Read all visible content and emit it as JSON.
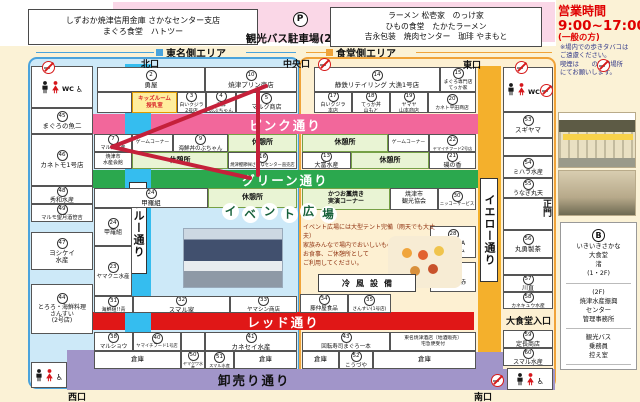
{
  "title_area": {
    "bank_box_line1": "しずおか焼津信用金庫 さかなセンター支店",
    "bank_box_line2": "まぐろ食堂　ハトツー",
    "parking_symbol": "P",
    "parking_label": "観光バス駐車場(25台)",
    "restaurants_line1": "ラーメン 松壱家　のっけ家",
    "restaurants_line2": "ひもの食堂　たかたラーメン",
    "restaurants_line3": "吉永包装　焼肉センター　珈琲 やまもと",
    "hours_title": "営業時間",
    "hours_time": "9:00~17:00",
    "hours_note": "(一般の方)"
  },
  "areas": {
    "left": "東名側エリア",
    "right": "食堂側エリア"
  },
  "streets": {
    "blue": "ブルー通り",
    "yellow": "イエロー通り",
    "pink": "ピンク通り",
    "green": "グリーン通り",
    "red": "レッド通り",
    "wholesale": "卸売り通り"
  },
  "event_plaza": {
    "title_chars": [
      "イ",
      "ベ",
      "ン",
      "ト",
      "広",
      "場"
    ],
    "text_lines": [
      "イベント広場には大型テント完備（雨天でも大丈夫）",
      "家族みんなで場内でおいしいものを買い",
      "お食事、ご休憩所として",
      "ご利用してください。"
    ],
    "cooling_label": "冷風設備"
  },
  "side_panel": {
    "smoking_lines": [
      "※場内での歩きタバコは",
      "ご遠慮ください。",
      "喫煙は　　の喫煙場所",
      "にてお願いします。"
    ],
    "directory": {
      "b_symbol": "B",
      "restaurant_lines": [
        "いきいきさかな",
        "大食堂",
        "渚",
        "(1・2F)"
      ],
      "office_lines": [
        "(2F)",
        "焼津水産振興",
        "センター",
        "管理事務所"
      ],
      "bus_lines": [
        "観光バス",
        "乗務員",
        "控え室"
      ]
    }
  },
  "map": {
    "gates": [
      {
        "label": "北口",
        "x": 141,
        "y": 57
      },
      {
        "label": "中央口",
        "x": 283,
        "y": 57
      },
      {
        "label": "東口",
        "x": 463,
        "y": 58
      },
      {
        "label": "西口",
        "x": 68,
        "y": 390
      },
      {
        "label": "南口",
        "x": 474,
        "y": 390
      },
      {
        "label": "正門",
        "x": 540,
        "y": 199,
        "v": true
      }
    ],
    "no_smoking": [
      {
        "x": 42,
        "y": 61
      },
      {
        "x": 318,
        "y": 58
      },
      {
        "x": 515,
        "y": 61
      },
      {
        "x": 540,
        "y": 84
      },
      {
        "x": 491,
        "y": 374
      },
      {
        "x": 597,
        "y": 59
      }
    ],
    "extra": [
      {
        "label": "大食堂入口",
        "x": 506,
        "y": 314,
        "size": 9
      }
    ],
    "cells": [
      {
        "x": 31,
        "y": 66,
        "w": 62,
        "h": 42,
        "t": "wc"
      },
      {
        "x": 31,
        "y": 108,
        "w": 62,
        "h": 26,
        "n": "45",
        "lines": [
          "まぐろの魚二"
        ]
      },
      {
        "x": 31,
        "y": 134,
        "w": 62,
        "h": 52,
        "n": "46",
        "lines": [
          "カネトモ1号店"
        ]
      },
      {
        "x": 31,
        "y": 186,
        "w": 62,
        "h": 18,
        "n": "48",
        "lines": [
          "秀和水産"
        ],
        "fs": 6
      },
      {
        "x": 31,
        "y": 204,
        "w": 62,
        "h": 18,
        "n": "49",
        "lines": [
          "マルモ望月酒笹吉"
        ],
        "fs": 5.2
      },
      {
        "x": 31,
        "y": 232,
        "w": 62,
        "h": 38,
        "n": "47",
        "lines": [
          "ヨシケイ",
          "水産"
        ]
      },
      {
        "x": 31,
        "y": 284,
        "w": 62,
        "h": 50,
        "n": "44",
        "lines": [
          "とろろ・海鮮料理",
          "さんすい",
          "(2号店)"
        ],
        "fs": 6
      },
      {
        "x": 31,
        "y": 362,
        "w": 36,
        "h": 26,
        "t": "wc2"
      },
      {
        "x": 97,
        "y": 67,
        "w": 108,
        "h": 25,
        "n": "2",
        "lines": [
          "勇屋"
        ]
      },
      {
        "x": 205,
        "y": 67,
        "w": 92,
        "h": 25,
        "n": "10",
        "lines": [
          "焼津プリン商店"
        ]
      },
      {
        "x": 97,
        "y": 92,
        "w": 35,
        "h": 21,
        "lines": [
          ""
        ]
      },
      {
        "x": 132,
        "y": 92,
        "w": 45,
        "h": 21,
        "t": "kids",
        "lines": [
          "キッズルーム",
          "授乳室"
        ]
      },
      {
        "x": 177,
        "y": 92,
        "w": 29,
        "h": 21,
        "n": "3",
        "lines": [
          "白いクジラ",
          "2号店"
        ],
        "fs": 4.8
      },
      {
        "x": 206,
        "y": 92,
        "w": 30,
        "h": 21,
        "n": "4",
        "lines": [
          "海鮮",
          "のぶちゃん"
        ],
        "fs": 4.8
      },
      {
        "x": 236,
        "y": 92,
        "w": 61,
        "h": 21,
        "n": "5",
        "lines": [
          "マルク商店"
        ],
        "fs": 6
      },
      {
        "x": 94,
        "y": 134,
        "w": 38,
        "h": 18,
        "n": "7",
        "lines": [
          "マル海水産"
        ],
        "fs": 5
      },
      {
        "x": 94,
        "y": 152,
        "w": 38,
        "h": 17,
        "lines": [
          "焼津市",
          "水産会館"
        ],
        "fs": 5
      },
      {
        "x": 132,
        "y": 134,
        "w": 41,
        "h": 18,
        "lines": [
          "ゲームコーナー"
        ],
        "fs": 4.8
      },
      {
        "x": 173,
        "y": 134,
        "w": 55,
        "h": 18,
        "n": "9",
        "lines": [
          "海鮮丼のぶちゃん"
        ],
        "fs": 5.5
      },
      {
        "x": 228,
        "y": 134,
        "w": 69,
        "h": 18,
        "t": "rest",
        "lines": [
          "休憩所"
        ]
      },
      {
        "x": 132,
        "y": 152,
        "w": 96,
        "h": 17,
        "t": "rest",
        "lines": [
          "休憩所"
        ]
      },
      {
        "x": 228,
        "y": 152,
        "w": 69,
        "h": 17,
        "n": "16",
        "lines": [
          "焼津鰹節㈱さかなセンター直売店"
        ],
        "fs": 4.3
      },
      {
        "x": 94,
        "y": 188,
        "w": 114,
        "h": 20,
        "n": "24",
        "lines": [
          "甲羅組"
        ]
      },
      {
        "x": 208,
        "y": 188,
        "w": 89,
        "h": 20,
        "t": "rest",
        "lines": [
          "休憩所"
        ]
      },
      {
        "x": 94,
        "y": 208,
        "w": 38,
        "h": 38,
        "n": "24",
        "lines": [
          "甲羅組"
        ],
        "fs": 6
      },
      {
        "x": 94,
        "y": 246,
        "w": 38,
        "h": 50,
        "n": "23",
        "lines": [
          "ヤマクニ水産"
        ],
        "fs": 5.5
      },
      {
        "x": 94,
        "y": 296,
        "w": 39,
        "h": 17,
        "n": "31",
        "lines": [
          "海鮮組!!青"
        ],
        "fs": 5
      },
      {
        "x": 133,
        "y": 296,
        "w": 97,
        "h": 17,
        "n": "32",
        "lines": [
          "スマル家"
        ]
      },
      {
        "x": 230,
        "y": 296,
        "w": 67,
        "h": 17,
        "n": "33",
        "lines": [
          "ヤマシン商店"
        ],
        "fs": 5.5
      },
      {
        "x": 94,
        "y": 332,
        "w": 39,
        "h": 19,
        "n": "38",
        "lines": [
          "マルショウ"
        ],
        "fs": 5.5
      },
      {
        "x": 133,
        "y": 332,
        "w": 48,
        "h": 19,
        "n": "40",
        "lines": [
          "ヤマイチフード1号店"
        ],
        "fs": 4.3
      },
      {
        "x": 181,
        "y": 332,
        "w": 24,
        "h": 19,
        "lines": [
          ""
        ]
      },
      {
        "x": 205,
        "y": 332,
        "w": 92,
        "h": 19,
        "n": "41",
        "lines": [
          "カネセイ水産"
        ]
      },
      {
        "x": 94,
        "y": 351,
        "w": 87,
        "h": 18,
        "t": "storage",
        "lines": [
          "倉庫"
        ]
      },
      {
        "x": 181,
        "y": 351,
        "w": 24,
        "h": 18,
        "n": "50",
        "lines": [
          "ヤマクワ水産"
        ],
        "fs": 4
      },
      {
        "x": 205,
        "y": 351,
        "w": 29,
        "h": 18,
        "n": "51",
        "lines": [
          "スマル水産"
        ],
        "fs": 4.2
      },
      {
        "x": 234,
        "y": 351,
        "w": 63,
        "h": 18,
        "t": "storage",
        "lines": [
          "倉庫"
        ]
      },
      {
        "x": 314,
        "y": 67,
        "w": 126,
        "h": 25,
        "n": "14",
        "lines": [
          "静鉄リテイリング 大漁1号店"
        ],
        "fs": 6.5
      },
      {
        "x": 440,
        "y": 67,
        "w": 36,
        "h": 25,
        "n": "15",
        "lines": [
          "まぐろ専門店",
          "てっか家"
        ],
        "fs": 4.8
      },
      {
        "x": 314,
        "y": 92,
        "w": 38,
        "h": 21,
        "n": "17",
        "lines": [
          "白いクジラ",
          "本店"
        ],
        "fs": 5
      },
      {
        "x": 352,
        "y": 92,
        "w": 38,
        "h": 21,
        "n": "18",
        "lines": [
          "てっか丼",
          "山もと"
        ],
        "fs": 5
      },
      {
        "x": 390,
        "y": 92,
        "w": 38,
        "h": 21,
        "n": "19",
        "lines": [
          "ヤマヤ",
          "山本商店"
        ],
        "fs": 5
      },
      {
        "x": 428,
        "y": 92,
        "w": 48,
        "h": 21,
        "n": "20",
        "lines": [
          "カネト平田商店"
        ],
        "fs": 4.8
      },
      {
        "x": 302,
        "y": 134,
        "w": 86,
        "h": 18,
        "t": "rest",
        "lines": [
          "休憩所"
        ]
      },
      {
        "x": 388,
        "y": 134,
        "w": 41,
        "h": 18,
        "lines": [
          "ゲームコーナー"
        ],
        "fs": 4.8
      },
      {
        "x": 429,
        "y": 134,
        "w": 47,
        "h": 18,
        "n": "22",
        "lines": [
          "ヤマイチフード2号店"
        ],
        "fs": 4.1
      },
      {
        "x": 302,
        "y": 152,
        "w": 49,
        "h": 17,
        "n": "13",
        "lines": [
          "大富水産"
        ],
        "fs": 6
      },
      {
        "x": 351,
        "y": 152,
        "w": 78,
        "h": 17,
        "t": "rest",
        "lines": [
          "休憩所"
        ]
      },
      {
        "x": 429,
        "y": 152,
        "w": 47,
        "h": 17,
        "n": "21",
        "lines": [
          "磯の香"
        ],
        "fs": 6
      },
      {
        "x": 302,
        "y": 188,
        "w": 88,
        "h": 22,
        "t": "rest",
        "lines": [
          "かつお藁焼き",
          "実演コーナー"
        ],
        "fs": 6
      },
      {
        "x": 390,
        "y": 188,
        "w": 48,
        "h": 22,
        "lines": [
          "焼津市",
          "観光協会"
        ],
        "fs": 6
      },
      {
        "x": 438,
        "y": 188,
        "w": 38,
        "h": 22,
        "n": "30",
        "lines": [
          "ニッコーサービス"
        ],
        "fs": 4.3
      },
      {
        "x": 430,
        "y": 226,
        "w": 46,
        "h": 32,
        "n": "28",
        "lines": [
          "SAKURA",
          "ファーム"
        ],
        "fs": 6
      },
      {
        "x": 430,
        "y": 262,
        "w": 46,
        "h": 30,
        "n": "27",
        "lines": [
          "海鮮組!!赤"
        ],
        "fs": 5.5
      },
      {
        "x": 300,
        "y": 294,
        "w": 48,
        "h": 19,
        "n": "34",
        "lines": [
          "藤仲屋食品"
        ],
        "fs": 5.5
      },
      {
        "x": 348,
        "y": 294,
        "w": 43,
        "h": 19,
        "n": "35",
        "lines": [
          "さんすい(1号店)"
        ],
        "fs": 4.6
      },
      {
        "x": 302,
        "y": 332,
        "w": 88,
        "h": 19,
        "n": "43",
        "lines": [
          "回転寿司まぐろ一本"
        ],
        "fs": 5.5
      },
      {
        "x": 390,
        "y": 332,
        "w": 86,
        "h": 19,
        "lines": [
          "東名焼津酒店〔地酒販売〕",
          "宅急便受付"
        ],
        "fs": 4.8
      },
      {
        "x": 302,
        "y": 351,
        "w": 37,
        "h": 18,
        "t": "storage",
        "lines": [
          "倉庫"
        ]
      },
      {
        "x": 339,
        "y": 351,
        "w": 34,
        "h": 18,
        "n": "52",
        "lines": [
          "こうづや"
        ],
        "fs": 5.5
      },
      {
        "x": 373,
        "y": 351,
        "w": 103,
        "h": 18,
        "t": "storage",
        "lines": [
          "倉庫"
        ]
      },
      {
        "x": 503,
        "y": 67,
        "w": 50,
        "h": 45,
        "t": "wc"
      },
      {
        "x": 503,
        "y": 112,
        "w": 50,
        "h": 26,
        "n": "53",
        "lines": [
          "スギヤマ"
        ]
      },
      {
        "x": 503,
        "y": 138,
        "w": 50,
        "h": 18,
        "lines": [
          ""
        ]
      },
      {
        "x": 503,
        "y": 156,
        "w": 50,
        "h": 22,
        "n": "54",
        "lines": [
          "ミハラ水産"
        ],
        "fs": 6
      },
      {
        "x": 503,
        "y": 178,
        "w": 50,
        "h": 20,
        "n": "55",
        "lines": [
          "うなぎ丸天"
        ],
        "fs": 6
      },
      {
        "x": 503,
        "y": 198,
        "w": 50,
        "h": 32,
        "lines": [
          ""
        ]
      },
      {
        "x": 503,
        "y": 230,
        "w": 50,
        "h": 28,
        "n": "56",
        "lines": [
          "丸勇製茶"
        ]
      },
      {
        "x": 503,
        "y": 258,
        "w": 50,
        "h": 17,
        "lines": [
          ""
        ]
      },
      {
        "x": 503,
        "y": 275,
        "w": 50,
        "h": 17,
        "n": "57",
        "lines": [
          "川直"
        ],
        "fs": 6
      },
      {
        "x": 503,
        "y": 292,
        "w": 50,
        "h": 17,
        "n": "58",
        "lines": [
          "カネキュウ水産"
        ],
        "fs": 4.8
      },
      {
        "x": 503,
        "y": 330,
        "w": 50,
        "h": 18,
        "n": "59",
        "lines": [
          "定長商店"
        ],
        "fs": 6
      },
      {
        "x": 503,
        "y": 348,
        "w": 50,
        "h": 18,
        "n": "60",
        "lines": [
          "スマル水産"
        ],
        "fs": 6
      },
      {
        "x": 507,
        "y": 368,
        "w": 46,
        "h": 22,
        "t": "wc2"
      }
    ]
  }
}
